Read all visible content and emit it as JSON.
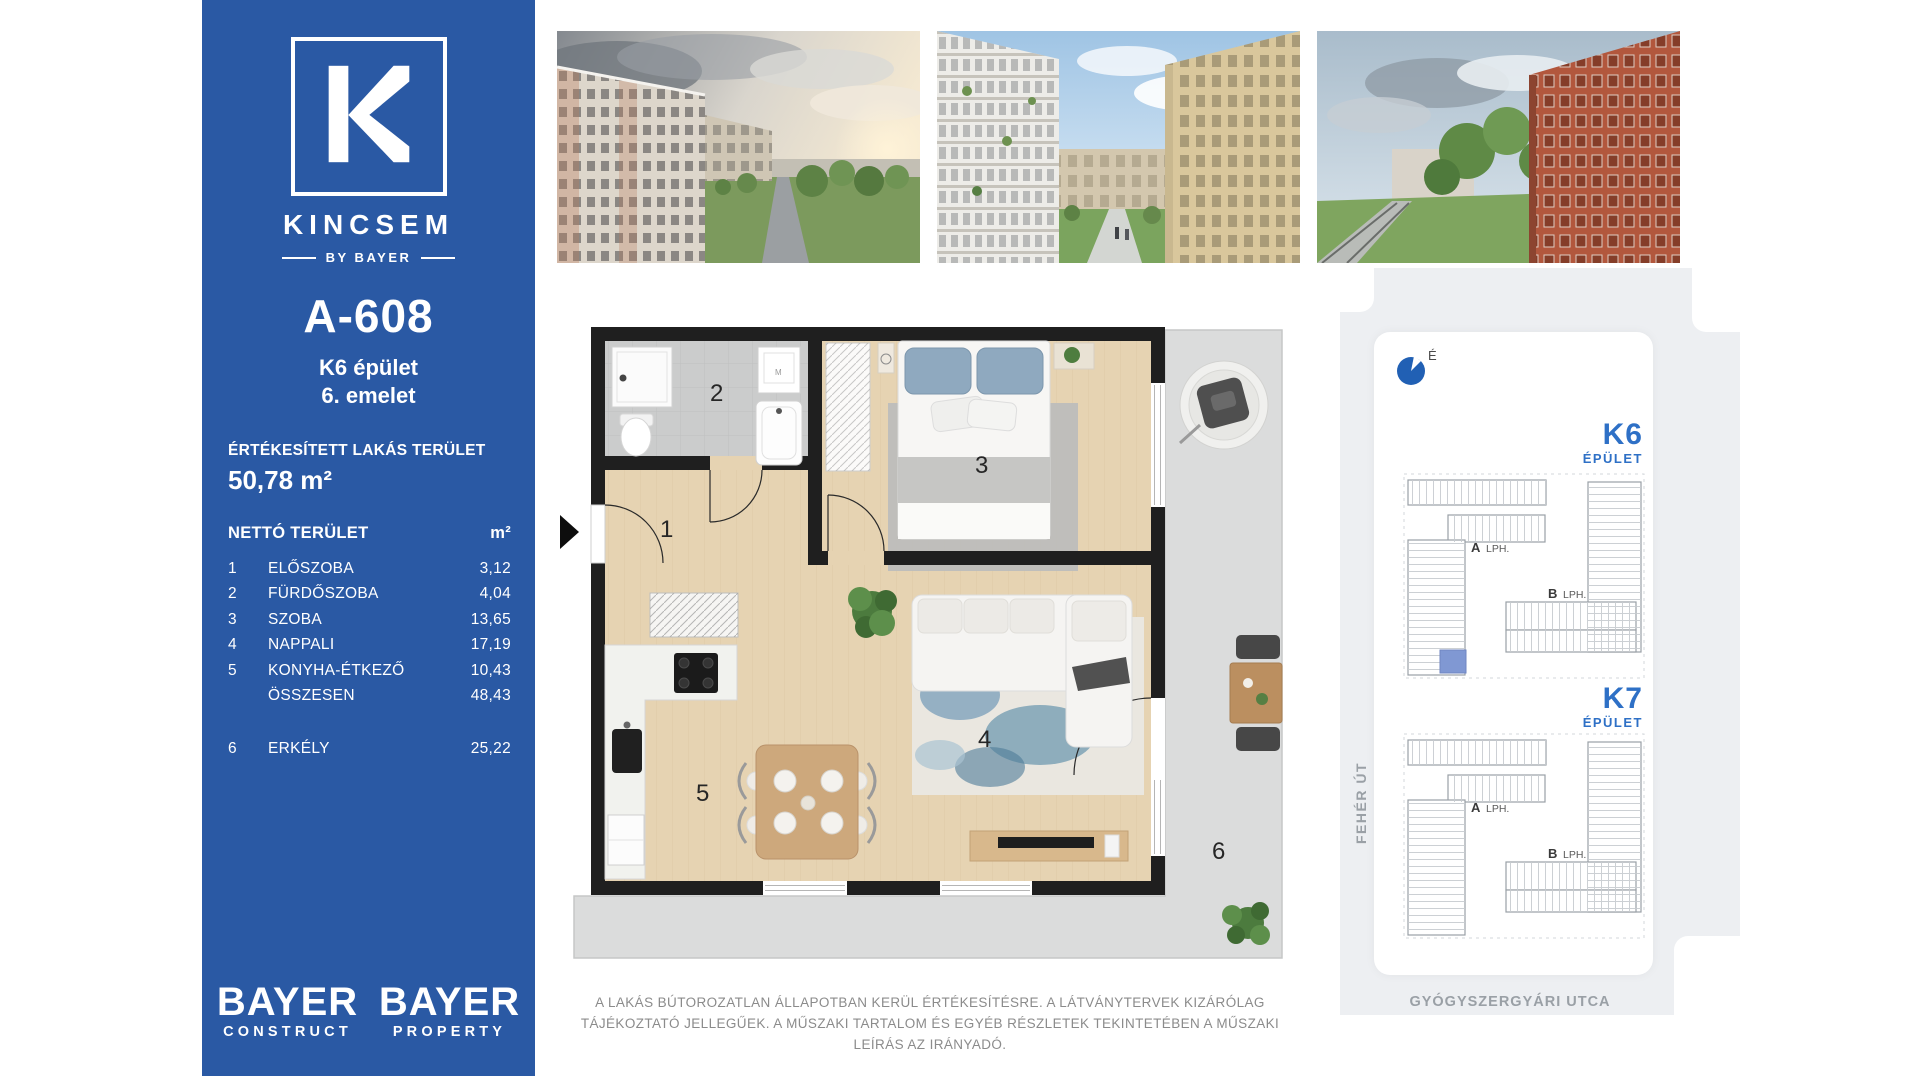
{
  "sidebar": {
    "brand": "KINCSEM",
    "byline": "BY BAYER",
    "unit_code": "A-608",
    "building": "K6 épület",
    "floor": "6. emelet",
    "sold_area_label": "ÉRTÉKESÍTETT LAKÁS TERÜLET",
    "sold_area_value": "50,78 m²",
    "table": {
      "title": "NETTÓ TERÜLET",
      "unit_header": "m²",
      "rows": [
        {
          "num": "1",
          "name": "ELŐSZOBA",
          "value": "3,12"
        },
        {
          "num": "2",
          "name": "FÜRDŐSZOBA",
          "value": "4,04"
        },
        {
          "num": "3",
          "name": "SZOBA",
          "value": "13,65"
        },
        {
          "num": "4",
          "name": "NAPPALI",
          "value": "17,19"
        },
        {
          "num": "5",
          "name": "KONYHA-ÉTKEZŐ",
          "value": "10,43"
        },
        {
          "num": "",
          "name": "ÖSSZESEN",
          "value": "48,43"
        },
        {
          "num": "6",
          "name": "ERKÉLY",
          "value": "25,22"
        }
      ]
    },
    "footer_logos": [
      {
        "title": "BAYER",
        "subtitle": "CONSTRUCT"
      },
      {
        "title": "BAYER",
        "subtitle": "PROPERTY"
      }
    ]
  },
  "floorplan": {
    "rooms": [
      "1",
      "2",
      "3",
      "4",
      "5",
      "6"
    ],
    "washer_label": "M"
  },
  "map": {
    "north_label": "É",
    "buildings": [
      {
        "code": "K6",
        "label": "ÉPÜLET",
        "lobby_a": "A",
        "lobby_a_suffix": "LPH.",
        "lobby_b": "B",
        "lobby_b_suffix": "LPH.",
        "highlighted_unit": true
      },
      {
        "code": "K7",
        "label": "ÉPÜLET",
        "lobby_a": "A",
        "lobby_a_suffix": "LPH.",
        "lobby_b": "B",
        "lobby_b_suffix": "LPH.",
        "highlighted_unit": false
      }
    ],
    "streets": {
      "left": "FEHÉR ÚT",
      "bottom": "GYÓGYSZERGYÁRI UTCA"
    }
  },
  "disclaimer": "A LAKÁS BÚTOROZATLAN ÁLLAPOTBAN KERÜL ÉRTÉKESÍTÉSRE. A LÁTVÁNYTERVEK KIZÁRÓLAG TÁJÉKOZTATÓ JELLEGŰEK. A MŰSZAKI TARTALOM ÉS EGYÉB RÉSZLETEK TEKINTETÉBEN A MŰSZAKI LEÍRÁS AZ IRÁNYADÓ.",
  "colors": {
    "sidebar_blue": "#2a59a4",
    "map_label_blue": "#2e70c6",
    "compass_blue": "#2160b4",
    "unit_highlight_blue": "#8098d3"
  }
}
